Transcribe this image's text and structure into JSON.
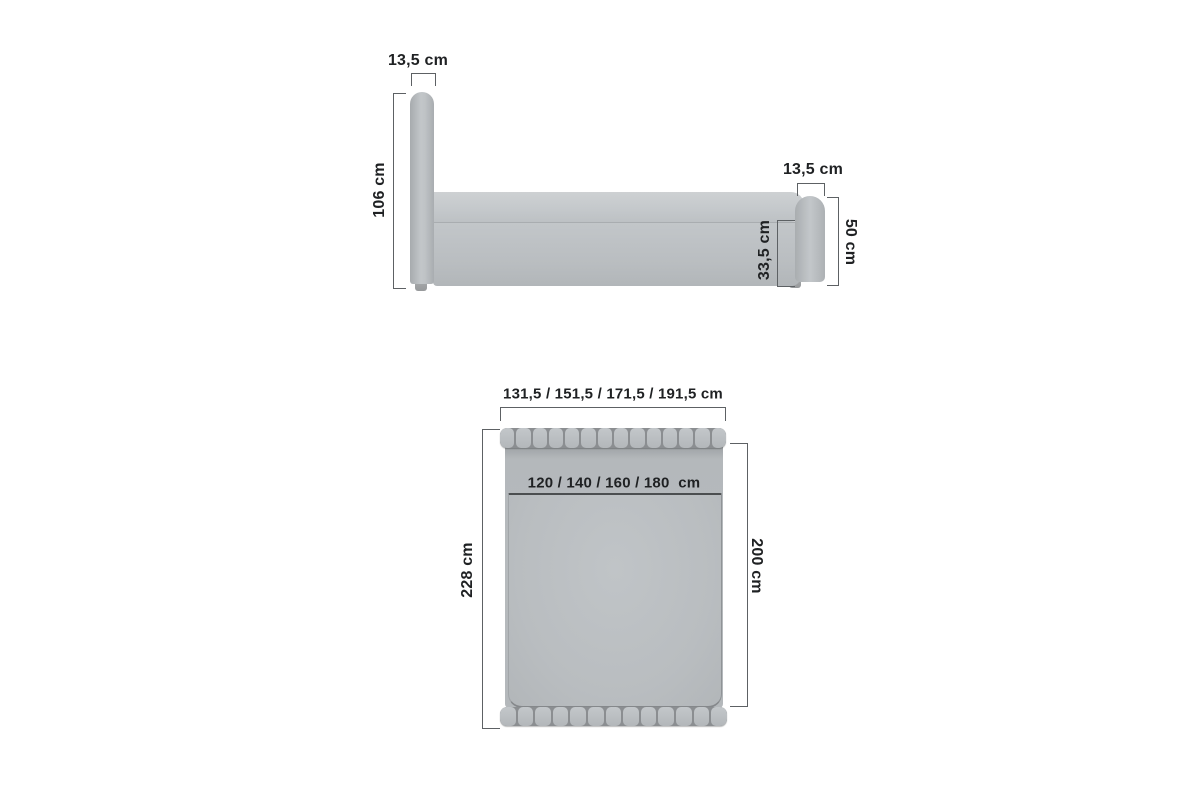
{
  "diagram": "upholstered-bed-dimensions",
  "colors": {
    "background": "#ffffff",
    "upholstery_gray": "#b7bbbe",
    "dimension_line": "#5d6164",
    "text": "#1f2123"
  },
  "side_view": {
    "headboard_width_label": "13,5 cm",
    "headboard_height_label": "106 cm",
    "footboard_width_label": "13,5 cm",
    "footboard_height_label": "50 cm",
    "frame_height_label": "33,5 cm"
  },
  "top_view": {
    "total_width_label": "131,5 / 151,5 / 171,5 / 191,5 cm",
    "mattress_width_label": "120 / 140 / 160 / 180  cm",
    "total_length_label": "228 cm",
    "mattress_length_label": "200 cm",
    "headboard_segments": 14,
    "footboard_segments": 13
  }
}
